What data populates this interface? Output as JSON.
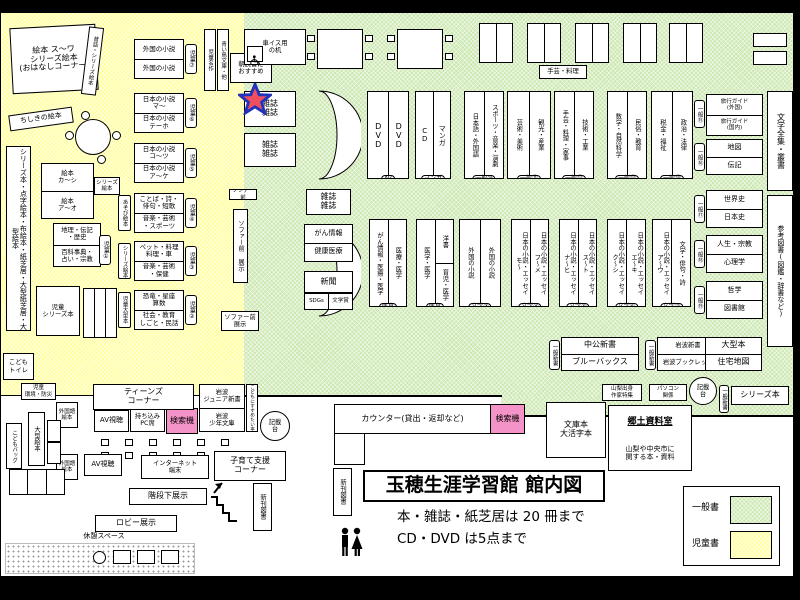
{
  "title": {
    "main": "玉穂生涯学習館 館内図",
    "rule1": "本・雑誌・紙芝居は 20 冊まで",
    "rule2": "CD・DVD は5点まで"
  },
  "legend": {
    "general": "一般書",
    "children": "児童書"
  },
  "colors": {
    "general_area": "#cbe7b0",
    "children_area": "#ffff9c",
    "search_machine": "#f493c7",
    "star_fill": "#f0505e",
    "star_border": "#2233bb"
  },
  "kids": {
    "ohanashi": "絵本 ス〜ワ\nシリーズ絵本\n(おはなしコーナー)",
    "mukashi": "昔話・シリーズ絵本",
    "chishiki": "ちしきの絵本",
    "meisaku": "児童名作",
    "aoitori": "青い鳥文庫・他",
    "asadoku": "朝読書に\nおすすめ",
    "wall": "シリーズ本・点字絵本・布絵本・紙芝居・大型紙芝居・大型絵本",
    "ehon_r1": "絵本\nカ〜シ",
    "ehon_r2": "絵本\nア〜オ",
    "ehon_tag": "シリーズ\n絵本",
    "chiri_r1": "地理・伝記\n・歴史",
    "chiri_r2": "百科事典・\n占い・宗教",
    "chiri_badge": "児童①",
    "series": "児童\nシリーズ本",
    "toilet": "こども\nトイレ",
    "kankyo": "児童\n環境・防災",
    "shelves": [
      {
        "r1": "外国の小説",
        "r2": "外国の小説",
        "badge": "児童⑦",
        "side": ""
      },
      {
        "r1": "日本の小説\nマ〜",
        "r2": "日本の小説\nテーホ",
        "badge": "児童⑥",
        "side": ""
      },
      {
        "r1": "日本の小説\nコ〜ツ",
        "r2": "日本の小説\nア〜ケ",
        "badge": "児童⑤",
        "side": ""
      },
      {
        "r1": "ことば・詩・\n俳句・短歌",
        "r2": "音楽・芸術\n・スポーツ",
        "badge": "児童④",
        "side": "あそび絵本"
      },
      {
        "r1": "ペット・料理\n料理・車",
        "r2": "音楽・芸術\n・保健",
        "badge": "児童③",
        "side": "シリーズ絵本"
      },
      {
        "r1": "恐竜・星座\n算数",
        "r2": "社会・教育\nしごと・民話",
        "badge": "児童②",
        "side": "児童大型本"
      }
    ]
  },
  "adult": {
    "wheelchair": "車イス用\nの机",
    "shugei": "手芸・料理",
    "mag_star": "雑誌\n雑誌",
    "mag_top": "雑誌\n雑誌",
    "sofa_tag_top": "ソファー前",
    "sofa_tag_mid": "ソファー前 展示",
    "sofa_tag_bottom": "ソファー前\n展示",
    "row1": [
      {
        "c1": "DVD",
        "c2": "DVD",
        "tag": "AV"
      },
      {
        "c1": "CD",
        "c2": "マンガ",
        "tag": "マンガ"
      },
      {
        "c1": "日本語・外国語",
        "c2": "スポーツ・音楽・演劇",
        "tag": "一般⑩"
      },
      {
        "c1": "芸術・美術",
        "c2": "観光・産業",
        "tag": "一般⑪"
      },
      {
        "c1": "手芸・料理・家事",
        "c2": "技術・工業",
        "tag": "一般⑫"
      },
      {
        "c1": "数学・自然科学",
        "c2": "民俗・教育",
        "tag": "一般⑬"
      },
      {
        "c1": "税金・福祉",
        "c2": "政治・法律",
        "tag": "一般⑭"
      }
    ],
    "row2": [
      {
        "c1": "がん情報・医療・医学",
        "c2": "医療・医学",
        "tag": "医育"
      },
      {
        "c1": "医学・医学",
        "c2a": "洋書",
        "c2b": "育児・医学",
        "tag": "医育"
      },
      {
        "c1": "外国の小説",
        "c2": "外国の小説",
        "tag": "文学③"
      },
      {
        "c1": "日本の小説・エッセイ\nモ〜",
        "c2": "日本の小説・エッセイ\nフ〜メ",
        "tag": "文学④"
      },
      {
        "c1": "日本の小説・エッセイ\nナ〜ヒ",
        "c2": "日本の小説・エッセイ\nス〜ト",
        "tag": "文学⑤"
      },
      {
        "c1": "日本の小説・エッセイ\nク〜シ",
        "c2": "日本の小説・エッセイ\nエ〜キ",
        "tag": "文学⑥"
      },
      {
        "c1": "日本の小説・エッセイ\nア〜ウ",
        "c2": "文学・俳句・詩",
        "tag": "文学⑦"
      }
    ],
    "mag2": "雑誌\n雑誌",
    "gan_r1": "がん情報",
    "gan_r2": "健康医療",
    "shinbun": "新聞",
    "sdgs_l": "SDGs",
    "sdgs_r": "文学賞",
    "right": [
      {
        "r1": "旅行ガイド\n(外国)",
        "r2": "旅行ガイド\n(国内)",
        "tag": "一般⑮"
      },
      {
        "r1": "地図",
        "r2": "伝記",
        "tag": "一般⑯"
      },
      {
        "r1": "世界史",
        "r2": "日本史",
        "tag": "一般⑰"
      },
      {
        "r1": "人生・宗教",
        "r2": "心理学",
        "tag": "一般⑱"
      },
      {
        "r1": "哲学",
        "r2": "図書館",
        "tag": "一般⑲"
      }
    ],
    "wall_bungaku": "文学全集・叢書",
    "wall_sanko": "参考図書(図鑑・辞書など)",
    "shinsho_tag1": "一般新書",
    "chuko_r1": "中公新書",
    "chuko_r2": "ブルーバックス",
    "shinsho_tag2": "一般新書",
    "iwanami_r1": "岩波新書",
    "iwanami_r2": "岩波ブックレット",
    "ogata_r1": "大型本",
    "ogata_r2": "住宅地図",
    "yamanashi": "山梨出身\n作家特集",
    "pasokon": "パソコン\n関係",
    "kisaidai": "記載\n台",
    "shinsho_tag3": "一般新書",
    "series": "シリーズ本",
    "bunko": "文庫本\n大活字本",
    "kyodo_title": "郷土資料室",
    "kyodo_desc": "山梨や中央市に\n関する本・資料"
  },
  "counter": {
    "label": "カウンター(貸出・返却など)",
    "search": "検索機"
  },
  "lobby": {
    "teens": "ティーンズ\nコーナー",
    "gaikoku1": "外国語\n絵本",
    "av1": "AV視聴",
    "pc": "持ち込み\nPC席",
    "search": "検索機",
    "iw_jr": "岩波\nジュニア新書",
    "iw_sh": "岩波\n少年文庫",
    "susume": "こどもにすすめたい本",
    "kisaidai": "記載\n台",
    "gaikoku2": "外国語\n絵本",
    "av2": "AV視聴",
    "internet": "インターネット\n端末",
    "kosodate": "子育て支援\nコーナー",
    "kaidan": "階段下展示",
    "lobby_d": "ロビー展示",
    "kyukei": "休憩スペース",
    "ogata": "大型絵本",
    "bag": "こどもバッグ",
    "shinkan1": "新刊図書",
    "shinkan2": "新刊図書"
  }
}
